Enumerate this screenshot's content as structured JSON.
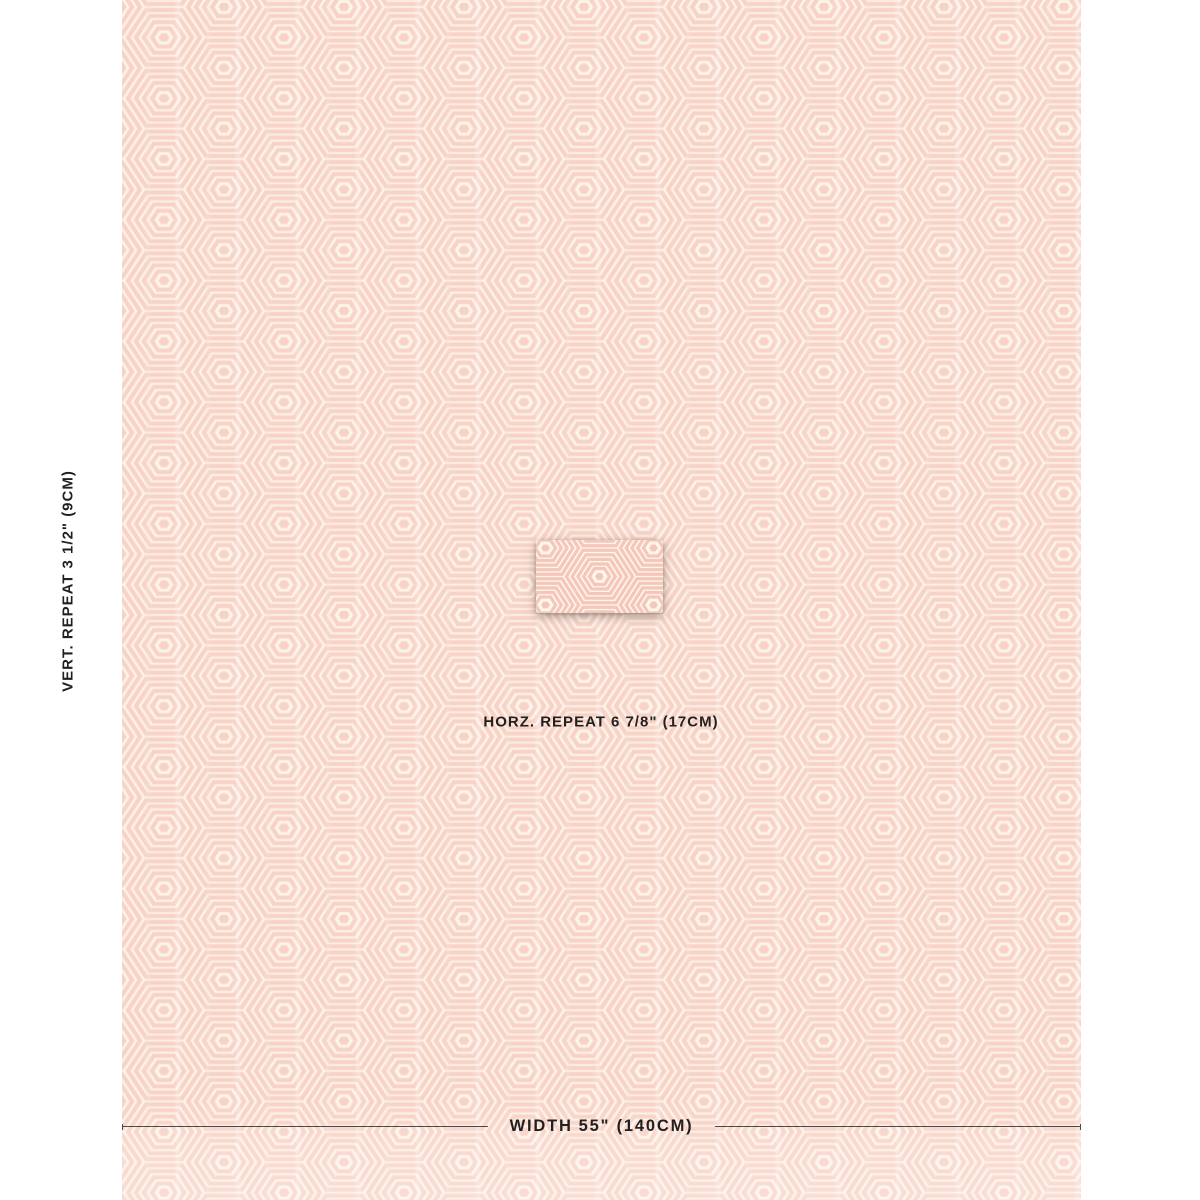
{
  "annotations": {
    "vertical_repeat": {
      "label": "VERT. REPEAT",
      "value": "3 1/2\" (9CM)"
    },
    "horizontal_repeat": {
      "label": "HORZ. REPEAT",
      "value": "6 7/8\" (17CM)"
    },
    "width": {
      "label": "WIDTH",
      "value": "55\" (140CM)"
    }
  },
  "fabric": {
    "pattern": "concentric-hexagons",
    "repeats_across_width": 8
  },
  "colors": {
    "page_background": "#ffffff",
    "fabric_ground": "#fdf6ec",
    "hexagon_pink": "#f8d2c6",
    "swatch_detail_pink": "#f5c7b9",
    "annotation_text": "#231f20",
    "rule_line": "#4a4a4a"
  }
}
